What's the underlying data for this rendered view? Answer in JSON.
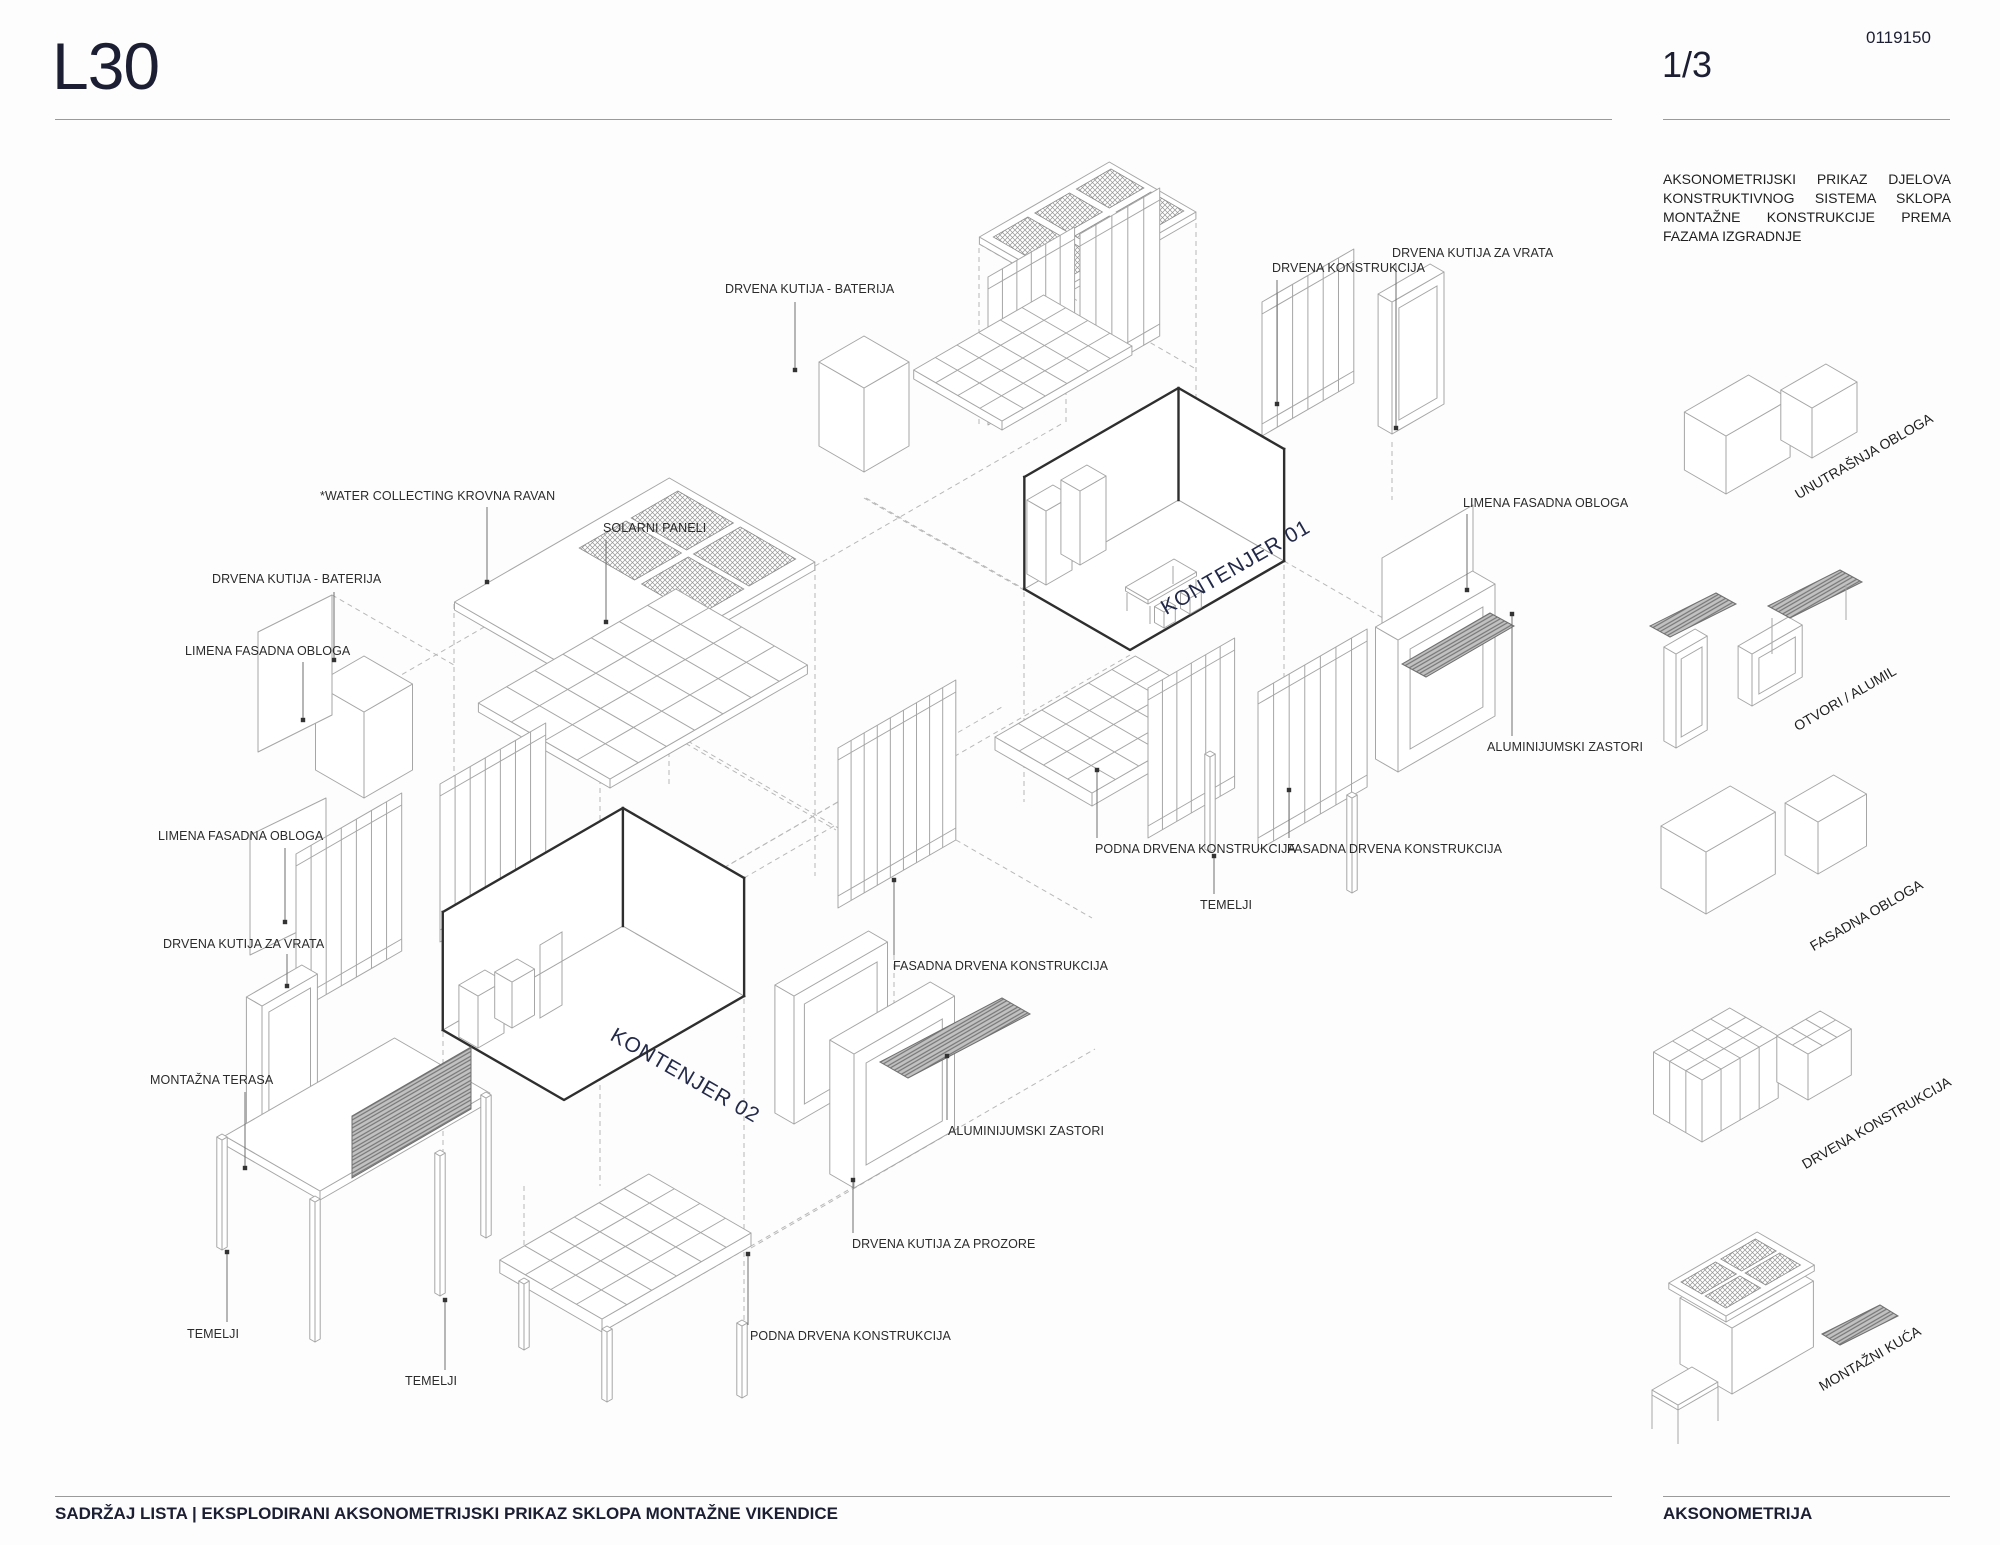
{
  "header": {
    "sheet_code": "L30",
    "doc_number": "0119150",
    "page": "1/3"
  },
  "right_panel": {
    "description": "AKSONOMETRIJSKI PRIKAZ DJELOVA KONSTRUKTIVNOG SISTEMA SKLOPA MONTAŽNE KONSTRUKCIJE PREMA FAZAMA IZGRADNJE",
    "legend": [
      {
        "label": "UNUTRAŠNJA OBLOGA"
      },
      {
        "label": "OTVORI / ALUMIL"
      },
      {
        "label": "FASADNA OBLOGA"
      },
      {
        "label": "DRVENA KONSTRUKCIJA"
      },
      {
        "label": "MONTAŽNI KUĆA"
      }
    ]
  },
  "drawing": {
    "containers": [
      {
        "label": "KONTENJER 01"
      },
      {
        "label": "KONTENJER 02"
      }
    ],
    "labels": [
      {
        "text": "DRVENA KUTIJA - BATERIJA"
      },
      {
        "text": "DRVENA KONSTRUKCIJA"
      },
      {
        "text": "DRVENA KUTIJA ZA VRATA"
      },
      {
        "text": "*WATER COLLECTING KROVNA RAVAN"
      },
      {
        "text": "SOLARNI PANELI"
      },
      {
        "text": "DRVENA KUTIJA - BATERIJA"
      },
      {
        "text": "LIMENA FASADNA OBLOGA"
      },
      {
        "text": "LIMENA FASADNA OBLOGA"
      },
      {
        "text": "ALUMINIJUMSKI ZASTORI"
      },
      {
        "text": "PODNA DRVENA KONSTRUKCIJA"
      },
      {
        "text": "FASADNA DRVENA KONSTRUKCIJA"
      },
      {
        "text": "TEMELJI"
      },
      {
        "text": "LIMENA FASADNA OBLOGA"
      },
      {
        "text": "DRVENA KUTIJA ZA VRATA"
      },
      {
        "text": "FASADNA DRVENA KONSTRUKCIJA"
      },
      {
        "text": "MONTAŽNA TERASA"
      },
      {
        "text": "ALUMINIJUMSKI ZASTORI"
      },
      {
        "text": "DRVENA KUTIJA ZA PROZORE"
      },
      {
        "text": "TEMELJI"
      },
      {
        "text": "TEMELJI"
      },
      {
        "text": "PODNA DRVENA KONSTRUKCIJA"
      }
    ]
  },
  "footer": {
    "left": "SADRŽAJ LISTA | EKSPLODIRANI AKSONOMETRIJSKI PRIKAZ SKLOPA MONTAŽNE VIKENDICE",
    "right": "AKSONOMETRIJA"
  },
  "colors": {
    "ink": "#1c1e33",
    "line_gray": "#a6a6a6",
    "label": "#2b2b2b",
    "container_label": "#232948"
  }
}
